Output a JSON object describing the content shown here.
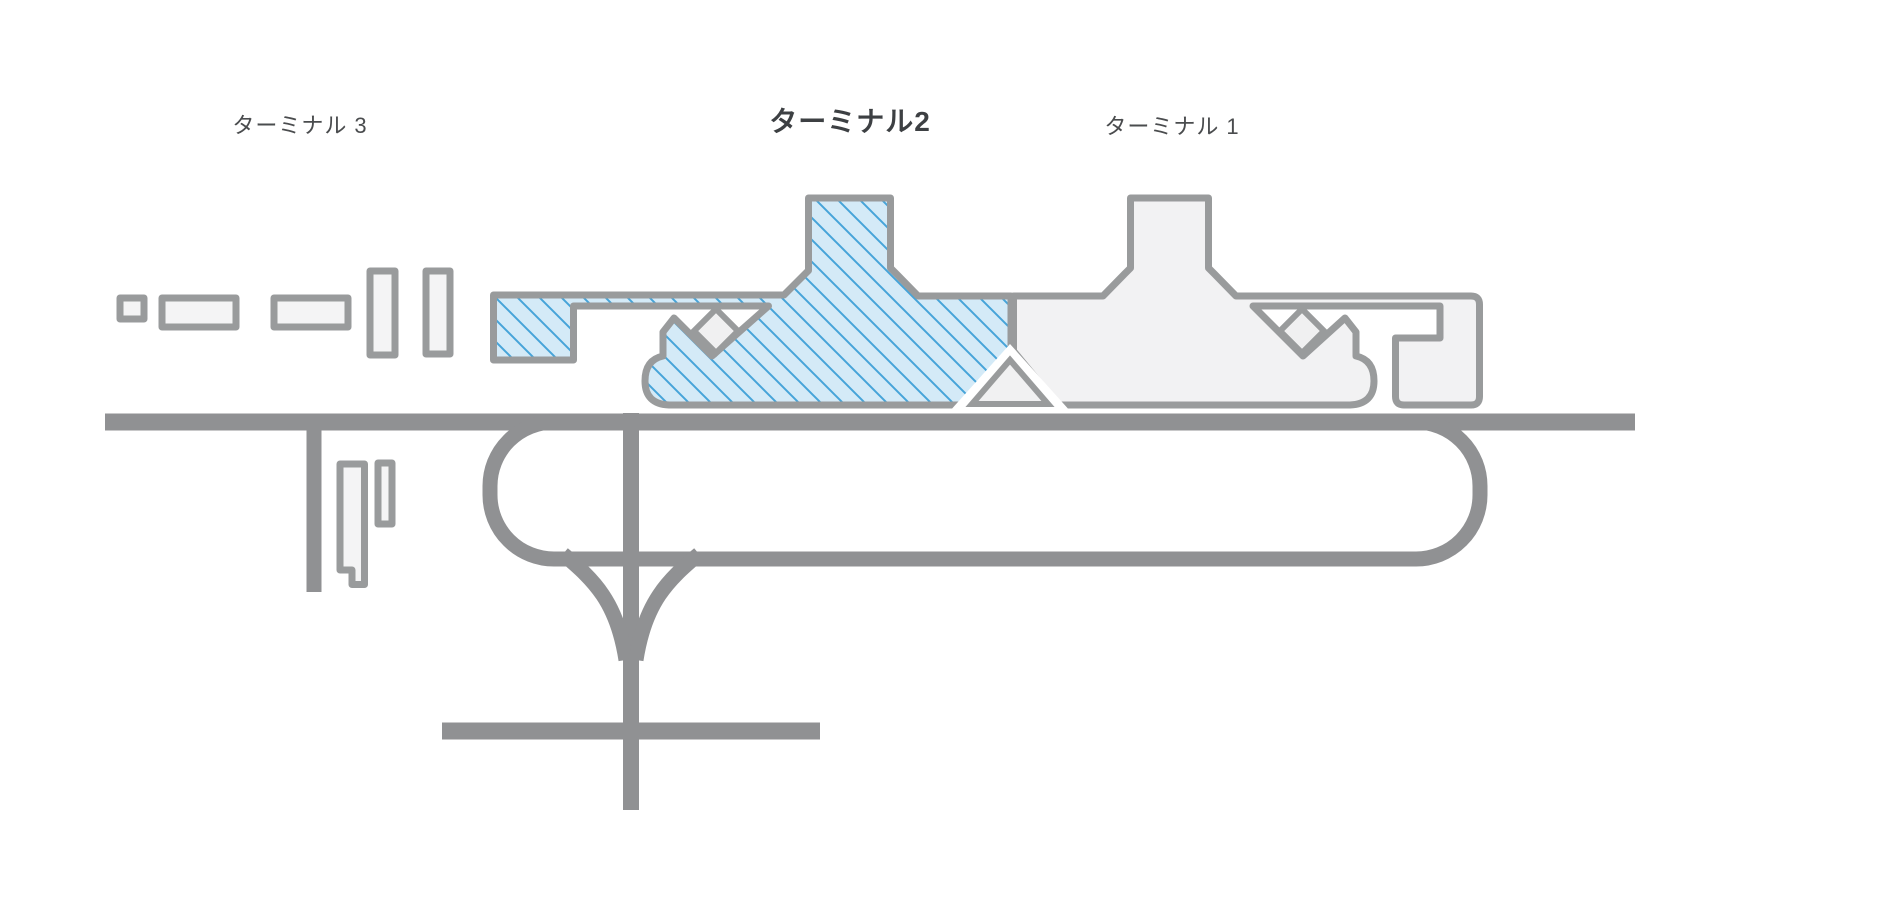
{
  "map": {
    "title": "airport-terminal-map",
    "terminals": [
      {
        "id": "terminal-3",
        "label": "ターミナル 3",
        "highlighted": false
      },
      {
        "id": "terminal-2",
        "label": "ターミナル2",
        "highlighted": true
      },
      {
        "id": "terminal-1",
        "label": "ターミナル 1",
        "highlighted": false
      }
    ],
    "colors": {
      "background": "#ffffff",
      "highlight_fill": "#d4eaf7",
      "highlight_hatch_line": "#46a4d9",
      "building_fill": "#f2f2f3",
      "building_outline": "#999b9c",
      "cutout_fill": "#f0f0f1",
      "road": "#909193",
      "label_text": "#4a4c4e",
      "selected_label_text": "#3d4043"
    }
  }
}
